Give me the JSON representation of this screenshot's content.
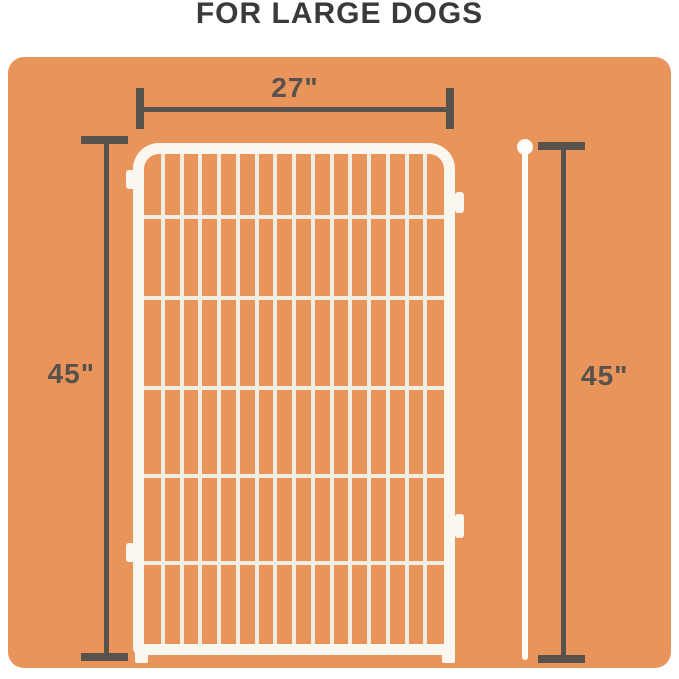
{
  "title": "FOR LARGE DOGS",
  "dimensions": {
    "width": {
      "label": "27\""
    },
    "height_left": {
      "label": "45\""
    },
    "height_right": {
      "label": "45\""
    }
  },
  "fence": {
    "vertical_bars": 15,
    "grid_width_px": 300,
    "grid_height_px": 490,
    "wire_tops_px": [
      61,
      142,
      232,
      320,
      407
    ]
  },
  "colors": {
    "background": "#FFFFFF",
    "panel": "#E8945B",
    "title_text": "#3A393B",
    "dimension": "#58524C",
    "fence_frame": "#FAF7EF",
    "fence_wire": "#F1EDE2",
    "stake": "#FFFDF8"
  }
}
